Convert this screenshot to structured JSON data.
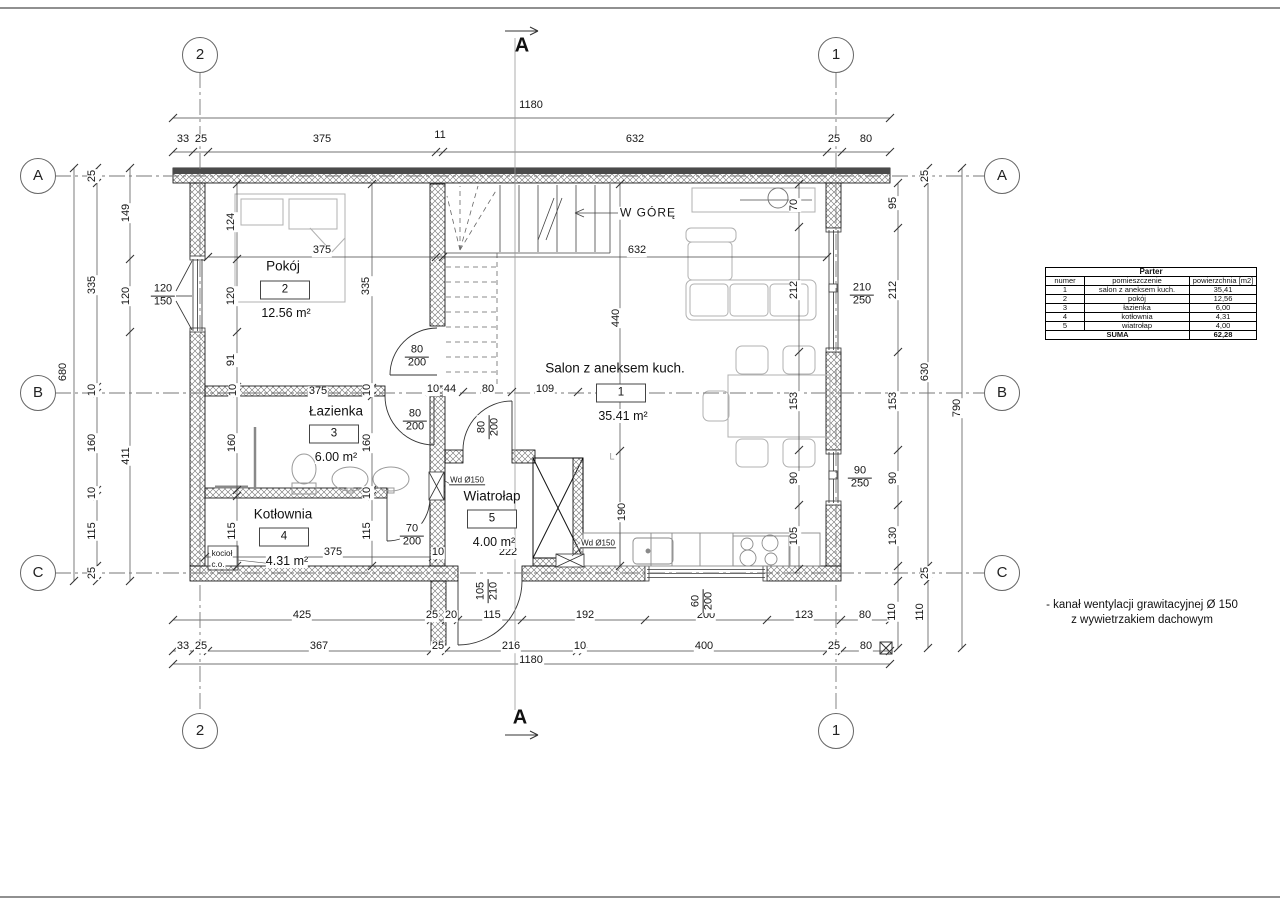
{
  "floor_name": "Parter",
  "section": {
    "label": "A",
    "top": {
      "x": 522,
      "y": 46
    },
    "bottom": {
      "x": 520,
      "y": 718
    }
  },
  "axes": {
    "top": [
      {
        "label": "2",
        "x": 200,
        "y": 55
      },
      {
        "label": "1",
        "x": 836,
        "y": 55
      }
    ],
    "bottom": [
      {
        "label": "2",
        "x": 200,
        "y": 731
      },
      {
        "label": "1",
        "x": 836,
        "y": 731
      }
    ],
    "left": [
      {
        "label": "A",
        "x": 38,
        "y": 176
      },
      {
        "label": "B",
        "x": 38,
        "y": 393
      },
      {
        "label": "C",
        "x": 38,
        "y": 573
      }
    ],
    "right": [
      {
        "label": "A",
        "x": 1002,
        "y": 176
      },
      {
        "label": "B",
        "x": 1002,
        "y": 393
      },
      {
        "label": "C",
        "x": 1002,
        "y": 573
      }
    ]
  },
  "rooms": [
    {
      "number": "1",
      "name": "Salon z aneksem kuch.",
      "area": "35.41 m²",
      "nx": 615,
      "ny": 368,
      "tx": 621,
      "ty": 393,
      "ax": 623,
      "ay": 416
    },
    {
      "number": "2",
      "name": "Pokój",
      "area": "12.56 m²",
      "nx": 283,
      "ny": 266,
      "tx": 285,
      "ty": 290,
      "ax": 286,
      "ay": 313
    },
    {
      "number": "3",
      "name": "Łazienka",
      "area": "6.00 m²",
      "nx": 336,
      "ny": 411,
      "tx": 334,
      "ty": 434,
      "ax": 336,
      "ay": 457
    },
    {
      "number": "4",
      "name": "Kotłownia",
      "area": "4.31 m²",
      "nx": 283,
      "ny": 514,
      "tx": 284,
      "ty": 537,
      "ax": 287,
      "ay": 561
    },
    {
      "number": "5",
      "name": "Wiatroł​ap",
      "area": "4.00 m²",
      "nx": 492,
      "ny": 496,
      "tx": 492,
      "ty": 519,
      "ax": 494,
      "ay": 542
    }
  ],
  "dim_labels": [
    {
      "t": "1180",
      "x": 531,
      "y": 106
    },
    {
      "t": "33",
      "x": 183,
      "y": 140
    },
    {
      "t": "25",
      "x": 201,
      "y": 140
    },
    {
      "t": "375",
      "x": 322,
      "y": 140
    },
    {
      "t": "11",
      "x": 440,
      "y": 136
    },
    {
      "t": "632",
      "x": 635,
      "y": 140
    },
    {
      "t": "25",
      "x": 834,
      "y": 140
    },
    {
      "t": "80",
      "x": 866,
      "y": 140
    },
    {
      "t": "425",
      "x": 302,
      "y": 616
    },
    {
      "t": "25",
      "x": 432,
      "y": 616
    },
    {
      "t": "20",
      "x": 451,
      "y": 616
    },
    {
      "t": "115",
      "x": 492,
      "y": 616
    },
    {
      "t": "192",
      "x": 585,
      "y": 616
    },
    {
      "t": "200",
      "x": 706,
      "y": 616
    },
    {
      "t": "123",
      "x": 804,
      "y": 616
    },
    {
      "t": "80",
      "x": 865,
      "y": 616
    },
    {
      "t": "110",
      "x": 893,
      "y": 612,
      "v": 1
    },
    {
      "t": "110",
      "x": 921,
      "y": 612,
      "v": 1
    },
    {
      "t": "33",
      "x": 183,
      "y": 647
    },
    {
      "t": "25",
      "x": 201,
      "y": 647
    },
    {
      "t": "367",
      "x": 319,
      "y": 647
    },
    {
      "t": "25",
      "x": 438,
      "y": 647
    },
    {
      "t": "216",
      "x": 511,
      "y": 647
    },
    {
      "t": "10",
      "x": 580,
      "y": 647
    },
    {
      "t": "400",
      "x": 704,
      "y": 647
    },
    {
      "t": "25",
      "x": 834,
      "y": 647
    },
    {
      "t": "80",
      "x": 866,
      "y": 647
    },
    {
      "t": "1180",
      "x": 531,
      "y": 661
    },
    {
      "t": "25",
      "x": 93,
      "y": 176,
      "v": 1
    },
    {
      "t": "335",
      "x": 93,
      "y": 285,
      "v": 1
    },
    {
      "t": "10",
      "x": 93,
      "y": 390,
      "v": 1
    },
    {
      "t": "160",
      "x": 93,
      "y": 443,
      "v": 1
    },
    {
      "t": "10",
      "x": 93,
      "y": 493,
      "v": 1
    },
    {
      "t": "115",
      "x": 93,
      "y": 531,
      "v": 1
    },
    {
      "t": "25",
      "x": 93,
      "y": 573,
      "v": 1
    },
    {
      "t": "149",
      "x": 127,
      "y": 213,
      "v": 1
    },
    {
      "t": "120",
      "x": 127,
      "y": 296,
      "v": 1
    },
    {
      "t": "411",
      "x": 127,
      "y": 456,
      "v": 1
    },
    {
      "t": "680",
      "x": 64,
      "y": 372,
      "v": 1
    },
    {
      "t": "95",
      "x": 894,
      "y": 203,
      "v": 1
    },
    {
      "t": "212",
      "x": 894,
      "y": 290,
      "v": 1
    },
    {
      "t": "153",
      "x": 894,
      "y": 401,
      "v": 1
    },
    {
      "t": "90",
      "x": 894,
      "y": 478,
      "v": 1
    },
    {
      "t": "130",
      "x": 894,
      "y": 536,
      "v": 1
    },
    {
      "t": "25",
      "x": 926,
      "y": 176,
      "v": 1
    },
    {
      "t": "630",
      "x": 926,
      "y": 372,
      "v": 1
    },
    {
      "t": "25",
      "x": 926,
      "y": 573,
      "v": 1
    },
    {
      "t": "790",
      "x": 958,
      "y": 408,
      "v": 1
    },
    {
      "t": "124",
      "x": 232,
      "y": 222,
      "v": 1
    },
    {
      "t": "120",
      "x": 232,
      "y": 296,
      "v": 1
    },
    {
      "t": "91",
      "x": 232,
      "y": 360,
      "v": 1
    },
    {
      "t": "335",
      "x": 367,
      "y": 286,
      "v": 1
    },
    {
      "t": "10",
      "x": 234,
      "y": 390,
      "v": 1
    },
    {
      "t": "10",
      "x": 368,
      "y": 390,
      "v": 1
    },
    {
      "t": "375",
      "x": 322,
      "y": 251
    },
    {
      "t": "632",
      "x": 637,
      "y": 251
    },
    {
      "t": "10",
      "x": 433,
      "y": 390
    },
    {
      "t": "44",
      "x": 450,
      "y": 390
    },
    {
      "t": "80",
      "x": 488,
      "y": 390
    },
    {
      "t": "109",
      "x": 545,
      "y": 390
    },
    {
      "t": "375",
      "x": 318,
      "y": 392
    },
    {
      "t": "440",
      "x": 617,
      "y": 318,
      "v": 1
    },
    {
      "t": "190",
      "x": 623,
      "y": 512,
      "v": 1
    },
    {
      "t": "70",
      "x": 795,
      "y": 205,
      "v": 1
    },
    {
      "t": "212",
      "x": 795,
      "y": 290,
      "v": 1
    },
    {
      "t": "153",
      "x": 795,
      "y": 401,
      "v": 1
    },
    {
      "t": "90",
      "x": 795,
      "y": 478,
      "v": 1
    },
    {
      "t": "105",
      "x": 795,
      "y": 536,
      "v": 1
    },
    {
      "t": "160",
      "x": 233,
      "y": 443,
      "v": 1
    },
    {
      "t": "160",
      "x": 368,
      "y": 443,
      "v": 1
    },
    {
      "t": "10",
      "x": 368,
      "y": 493,
      "v": 1
    },
    {
      "t": "115",
      "x": 233,
      "y": 531,
      "v": 1
    },
    {
      "t": "115",
      "x": 368,
      "y": 531,
      "v": 1
    },
    {
      "t": "375",
      "x": 333,
      "y": 553
    },
    {
      "t": "10",
      "x": 438,
      "y": 553
    },
    {
      "t": "222",
      "x": 508,
      "y": 553
    }
  ],
  "frac_labels": [
    {
      "top": "80",
      "bot": "200",
      "x": 417,
      "y": 357
    },
    {
      "top": "80",
      "bot": "200",
      "x": 415,
      "y": 421
    },
    {
      "top": "80",
      "bot": "200",
      "x": 489,
      "y": 427,
      "v": 1
    },
    {
      "top": "70",
      "bot": "200",
      "x": 412,
      "y": 536
    },
    {
      "top": "120",
      "bot": "150",
      "x": 163,
      "y": 296
    },
    {
      "top": "210",
      "bot": "250",
      "x": 862,
      "y": 295
    },
    {
      "top": "90",
      "bot": "250",
      "x": 860,
      "y": 478
    },
    {
      "top": "105",
      "bot": "210",
      "x": 488,
      "y": 591,
      "v": 1
    },
    {
      "top": "60",
      "bot": "200",
      "x": 703,
      "y": 601,
      "v": 1
    }
  ],
  "misc_labels": [
    {
      "t": "W GÓRĘ",
      "x": 648,
      "y": 213,
      "cls": "up"
    },
    {
      "t": "kocioł",
      "x": 222,
      "y": 554,
      "cls": "tiny"
    },
    {
      "t": "c.o.",
      "x": 218,
      "y": 565,
      "cls": "tiny"
    },
    {
      "t": "Wd Ø150",
      "x": 467,
      "y": 481,
      "cls": "wd"
    },
    {
      "t": "Wd Ø150",
      "x": 598,
      "y": 544,
      "cls": "wd"
    },
    {
      "t": "L",
      "x": 612,
      "y": 457,
      "cls": "lmark"
    }
  ],
  "note": {
    "line1": "- kanał wentylacji grawitacyjnej Ø 150",
    "line2": "z wywietrzakiem dachowym"
  },
  "table": {
    "title": "Parter",
    "headers": [
      "numer",
      "pomieszczenie",
      "powierzchnia [m2]"
    ],
    "rows": [
      [
        "1",
        "salon z aneksem kuch.",
        "35,41"
      ],
      [
        "2",
        "pokój",
        "12,56"
      ],
      [
        "3",
        "łazienka",
        "6,00"
      ],
      [
        "4",
        "kotłownia",
        "4,31"
      ],
      [
        "5",
        "wiatrołap",
        "4,00"
      ]
    ],
    "sum_label": "SUMA",
    "sum_value": "62,28"
  }
}
